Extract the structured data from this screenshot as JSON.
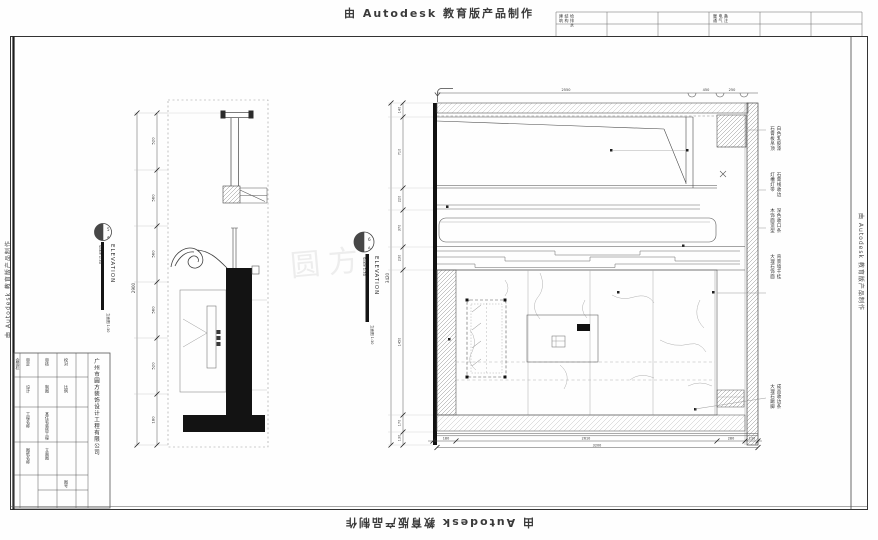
{
  "watermarks": {
    "top": "由 Autodesk 教育版产品制作",
    "bottom": "由 Autodesk 教育版产品制作",
    "left": "由 Autodesk 教育版产品制作",
    "right": "由 Autodesk 教育版产品制作",
    "center": "圆方"
  },
  "header_strip": {
    "cell_a": [
      "建筑",
      "结构",
      "给排水"
    ],
    "cell_b": [
      "暖通",
      "电气",
      "备注"
    ]
  },
  "titles": {
    "left": {
      "number": "5",
      "letter": "A",
      "name": "ELEVATION",
      "scale": "Scale 1:30",
      "note": "立面图 1:30"
    },
    "right": {
      "number": "6",
      "letter": "A",
      "name": "ELEVATION",
      "scale": "Scale 1:30",
      "note": "立面图 1:30"
    }
  },
  "left_drawing": {
    "dim_total": "2900",
    "dim_segments": [
      "520",
      "560",
      "560",
      "560",
      "520",
      "180"
    ]
  },
  "right_drawing": {
    "dim_left_total": "3420",
    "dim_left_segments": [
      "140",
      "710",
      "220",
      "370",
      "230",
      "1450",
      "170",
      "130"
    ],
    "dim_top": [
      "2550",
      "450",
      "250"
    ],
    "dim_bottom": [
      "180",
      "2610",
      "280",
      "130"
    ],
    "dim_bottom_total": "3200",
    "annotations": [
      {
        "line1": "石膏板吊顶",
        "line2": "白色乳胶漆"
      },
      {
        "line1": "灯槽灯带",
        "line2": "石膏线收边"
      },
      {
        "line1": "木饰面造型",
        "line2": "深色收口条"
      },
      {
        "line1": "大理石饰面",
        "line2": "背景墙干挂"
      },
      {
        "line1": "大理石踢脚",
        "line2": "成品收边条"
      }
    ]
  },
  "title_block": {
    "company": "广州市圆方装饰设计工程有限公司",
    "cells": [
      "会签栏",
      "审定",
      "审核",
      "校对",
      "设计",
      "制图",
      "比例",
      "工程名称",
      "某住宅装饰工程",
      "图纸名称",
      "立面图",
      "图号"
    ]
  }
}
